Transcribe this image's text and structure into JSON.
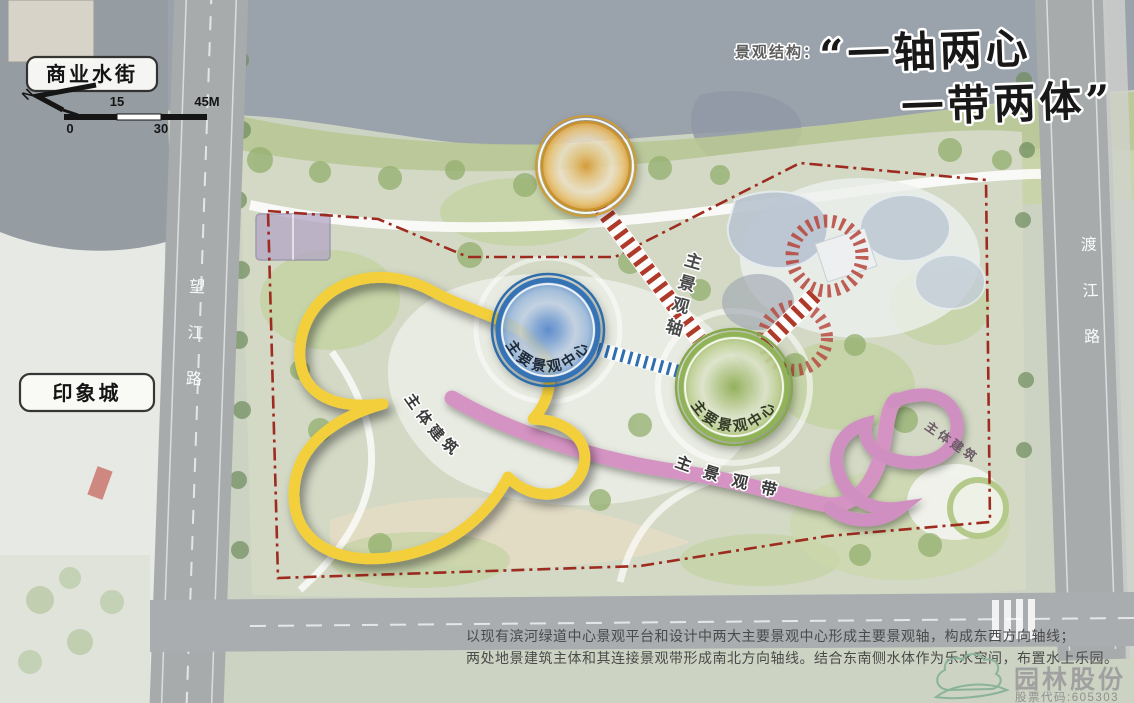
{
  "title": {
    "prefix": "景观结构：",
    "line1": "“一轴两心",
    "line2": "一带两体”"
  },
  "map_labels": {
    "business_water_street": "商业水街",
    "impression_city": "印象城",
    "road_left": "望江路",
    "road_right": "渡江路"
  },
  "compass": {
    "north": "N"
  },
  "scale_bar": {
    "tick_0": "0",
    "tick_15": "15",
    "tick_30": "30",
    "tick_45": "45M"
  },
  "annotations": {
    "main_axis": "主景观轴",
    "main_belt": "主景观带",
    "center_blue": "主要景观中心",
    "center_green": "主要景观中心",
    "building_left": "主体建筑",
    "building_right": "主体建筑"
  },
  "description": {
    "line1": "以现有滨河绿道中心景观平台和设计中两大主要景观中心形成主要景观轴，构成东西方向轴线；",
    "line2": "两处地景建筑主体和其连接景观带形成南北方向轴线。结合东南侧水体作为乐水空间，布置水上乐园。"
  },
  "logo": {
    "company": "园林股份",
    "stock_code": "股票代码:605303"
  },
  "colors": {
    "axis_red": "#b03a2a",
    "boundary_red": "#9e2b20",
    "node_orange": "#e2a33c",
    "node_blue": "#4a7fc0",
    "node_green": "#9cb963",
    "belt_pink": "#d593c3",
    "building_yellow": "#f2cf3b"
  }
}
